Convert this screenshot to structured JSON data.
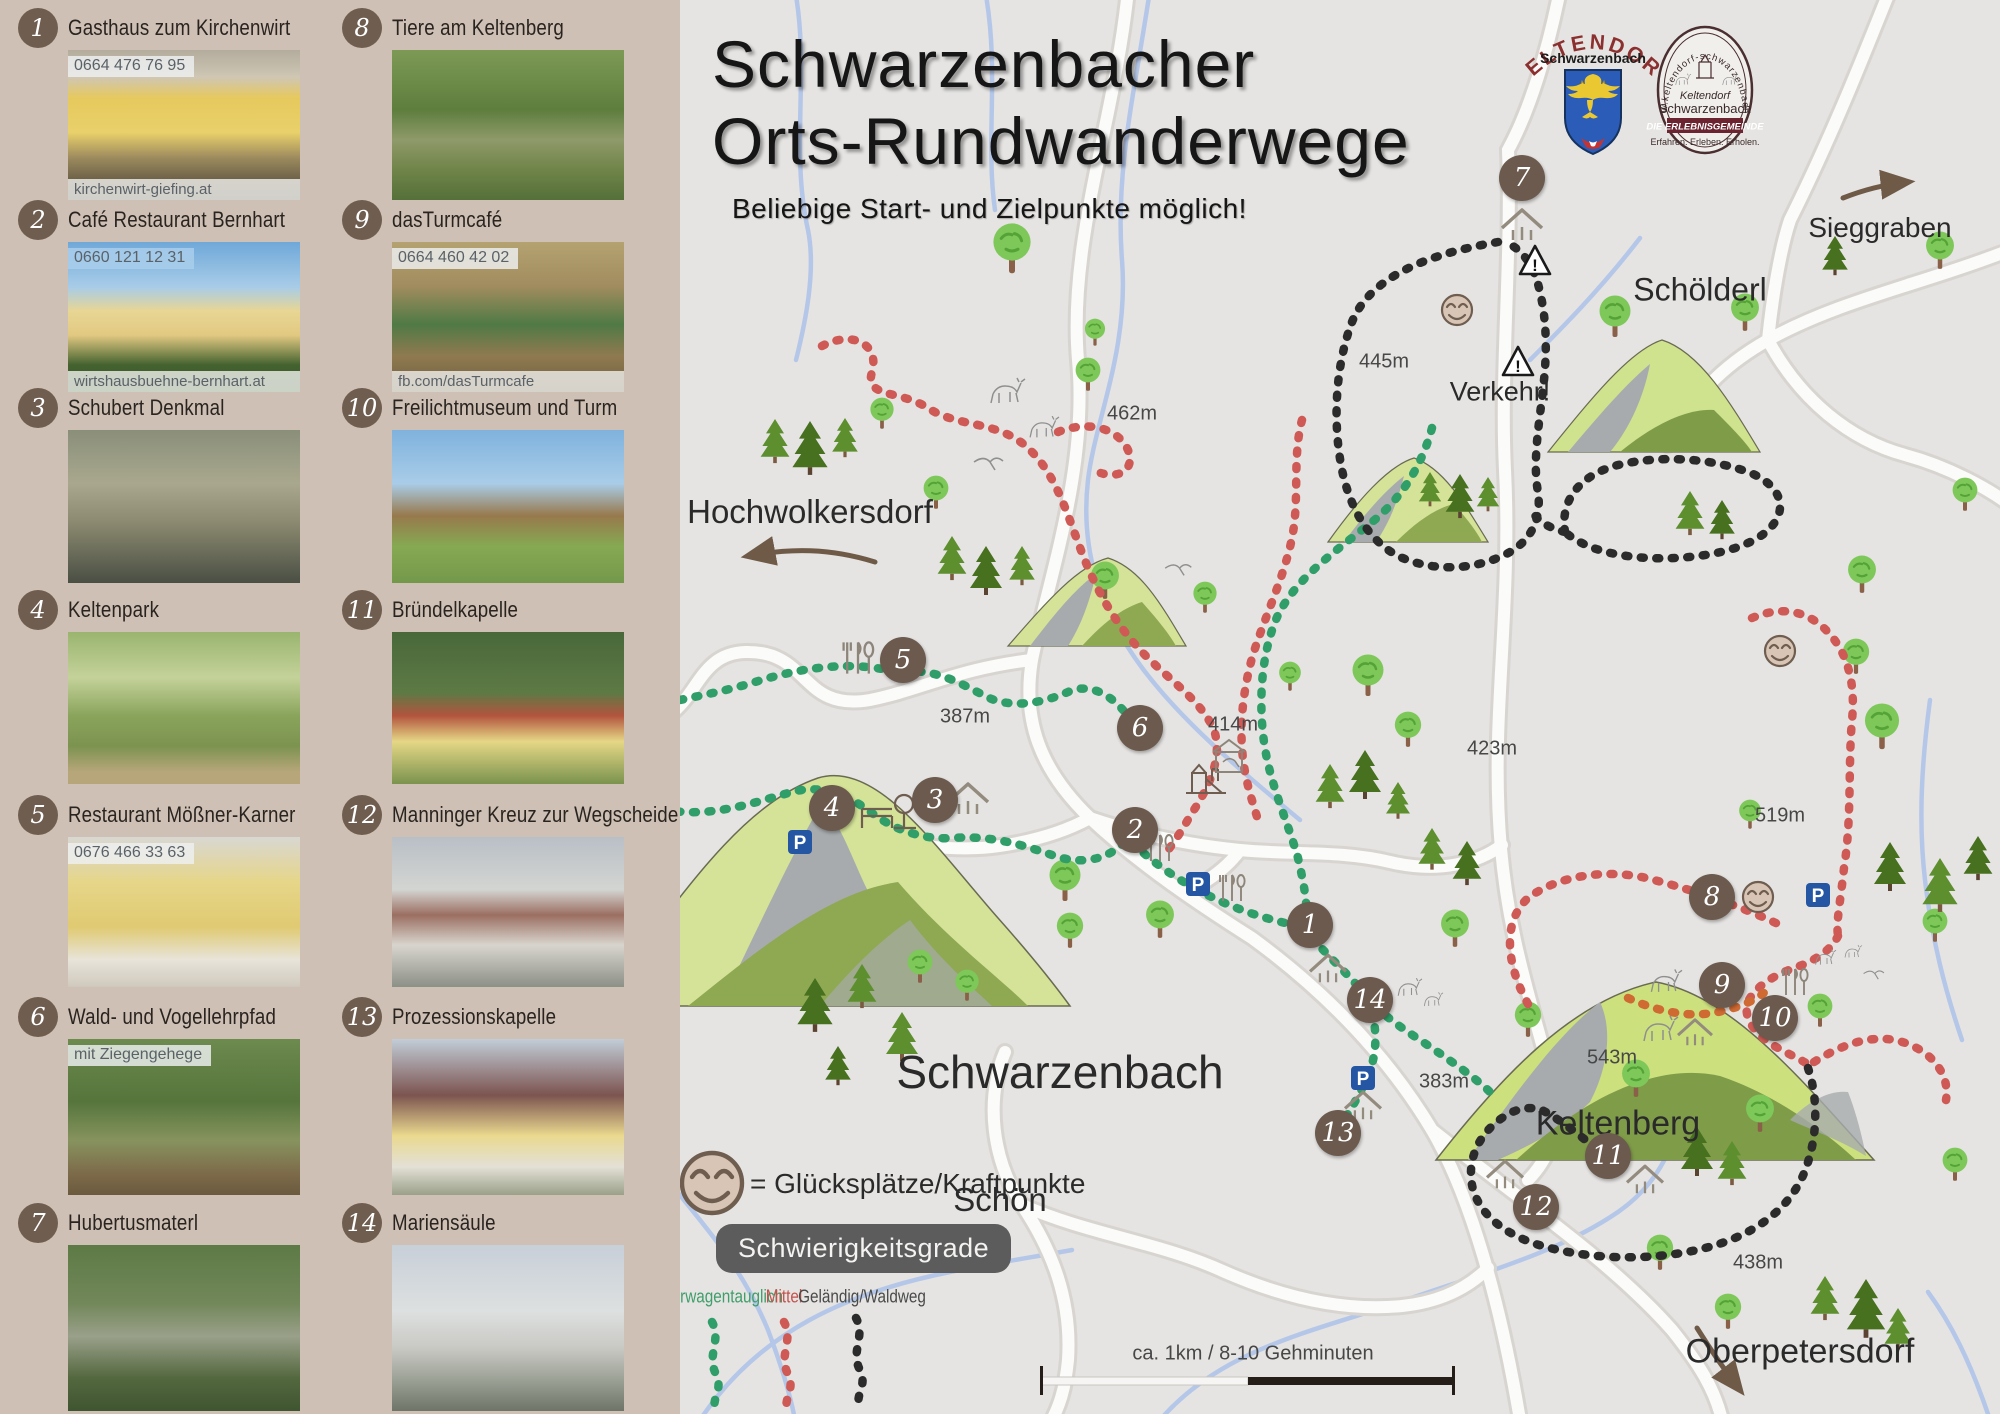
{
  "header": {
    "title_line1": "Schwarzenbacher",
    "title_line2": "Orts-Rundwanderwege",
    "subtitle": "Beliebige Start- und Zielpunkte möglich!"
  },
  "sidebar": {
    "items": [
      {
        "num": "1",
        "title": "Gasthaus zum Kirchenwirt",
        "phone": "0664 476 76 95",
        "url": "kirchenwirt-giefing.at"
      },
      {
        "num": "2",
        "title": "Café Restaurant Bernhart",
        "phone": "0660 121 12 31",
        "url": "wirtshausbuehne-bernhart.at"
      },
      {
        "num": "3",
        "title": "Schubert Denkmal"
      },
      {
        "num": "4",
        "title": "Keltenpark"
      },
      {
        "num": "5",
        "title": "Restaurant Mößner-Karner",
        "phone": "0676 466 33 63"
      },
      {
        "num": "6",
        "title": "Wald- und Vogellehrpfad",
        "caption": "mit Ziegengehege"
      },
      {
        "num": "7",
        "title": "Hubertusmaterl"
      },
      {
        "num": "8",
        "title": "Tiere am Keltenberg"
      },
      {
        "num": "9",
        "title": "dasTurmcafé",
        "phone": "0664 460 42 02",
        "url": "fb.com/dasTurmcafe"
      },
      {
        "num": "10",
        "title": "Freilichtmuseum und Turm"
      },
      {
        "num": "11",
        "title": "Bründelkapelle"
      },
      {
        "num": "12",
        "title": "Manninger Kreuz zur Wegscheide"
      },
      {
        "num": "13",
        "title": "Prozessionskapelle"
      },
      {
        "num": "14",
        "title": "Mariensäule"
      }
    ]
  },
  "logos": {
    "coat": {
      "top": "KELTENDORF",
      "sub": "Schwarzenbach"
    },
    "stamp": {
      "arc": "www.keltendorf-schwarzenbach.at",
      "line1": "Keltendorf",
      "line2": "Schwarzenbach",
      "banner": "DIE ERLEBNISGEMEINDE",
      "tagline": "Erfahren. Erleben. Erholen."
    }
  },
  "map": {
    "markers": [
      "1",
      "2",
      "3",
      "4",
      "5",
      "6",
      "7",
      "8",
      "9",
      "10",
      "11",
      "12",
      "13",
      "14"
    ],
    "places": {
      "hochwolkersdorf": "Hochwolkersdorf",
      "sieggraben": "Sieggraben",
      "schoelderl": "Schölderl",
      "schwarzenbach": "Schwarzenbach",
      "schoen": "Schön",
      "keltenberg": "Keltenberg",
      "oberpetersdorf": "Oberpetersdorf"
    },
    "warning": "Verkehr!",
    "elevations": [
      "462m",
      "445m",
      "387m",
      "414m",
      "423m",
      "519m",
      "543m",
      "383m",
      "438m"
    ]
  },
  "legend": {
    "smiley_label": "= Glücksplätze/Kraftpunkte",
    "difficulty_title": "Schwierigkeitsgrade",
    "levels": [
      {
        "label": "Kinderwagentauglich",
        "color": "#3f9e6a"
      },
      {
        "label": "Mittel",
        "color": "#c4524d"
      },
      {
        "label": "Geländig/Waldweg",
        "color": "#4a4a4a"
      }
    ],
    "scale_label": "ca. 1km / 8-10 Gehminuten"
  },
  "colors": {
    "trail_easy": "#2f9e68",
    "trail_medium": "#cf5a55",
    "trail_hard": "#2b2b2b",
    "sidebar_bg": "#cec0b4",
    "marker": "#6b5a4d",
    "parking": "#2456a4"
  }
}
